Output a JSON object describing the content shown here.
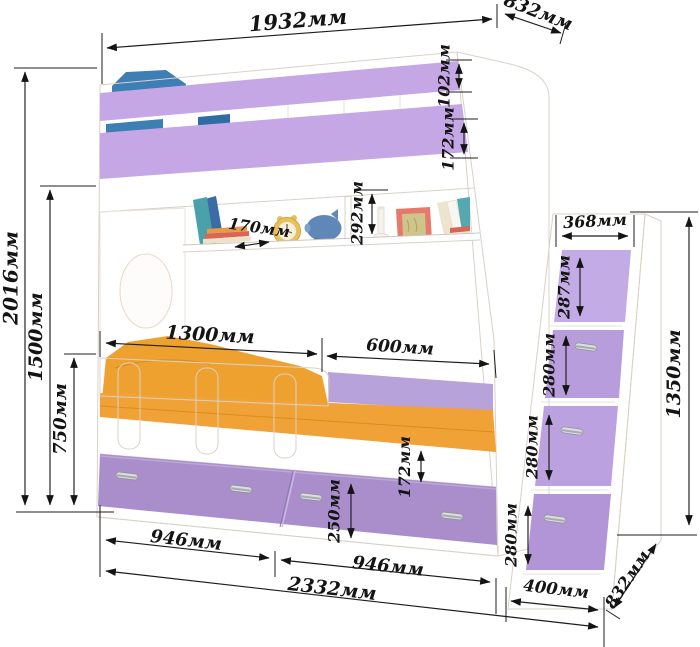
{
  "diagram": {
    "type": "furniture-dimension-drawing",
    "subject": "children's bunk bed with guard rails, shelf, two under-bed drawers and stair-drawer module",
    "unit": "мм"
  },
  "palette": {
    "rail_purple": "#c6a7e5",
    "drawer_purple": "#a98ecb",
    "stair_step_purple": "#bda2e0",
    "mattress_orange": "#f1a236",
    "pillow_blue": "#3d7eb4",
    "headboard_cream": "#f4e9dd",
    "panel_white": "#ffffff",
    "dimension_ink": "#1c1c1c"
  },
  "dimensions": {
    "top_width": "1932мм",
    "top_depth": "832мм",
    "upper_rail_board": "102мм",
    "upper_rail_lower_board": "172мм",
    "total_height": "2016мм",
    "upper_bed_height": "1500мм",
    "lower_rail_height": "750мм",
    "shelf_depth": "170мм",
    "shelf_opening_height": "292мм",
    "guard_rail_length": "1300мм",
    "open_side_length": "600мм",
    "under_bed_gap": "172мм",
    "drawer_height": "250мм",
    "left_drawer_width": "946мм",
    "right_drawer_width": "946мм",
    "base_total_width": "2332мм",
    "stair_top_depth": "368мм",
    "stair_step_1": "287мм",
    "stair_step_2": "280мм",
    "stair_step_3": "280мм",
    "stair_step_4": "280мм",
    "stair_height": "1350мм",
    "stair_base_depth": "400мм",
    "bottom_depth": "832мм"
  }
}
